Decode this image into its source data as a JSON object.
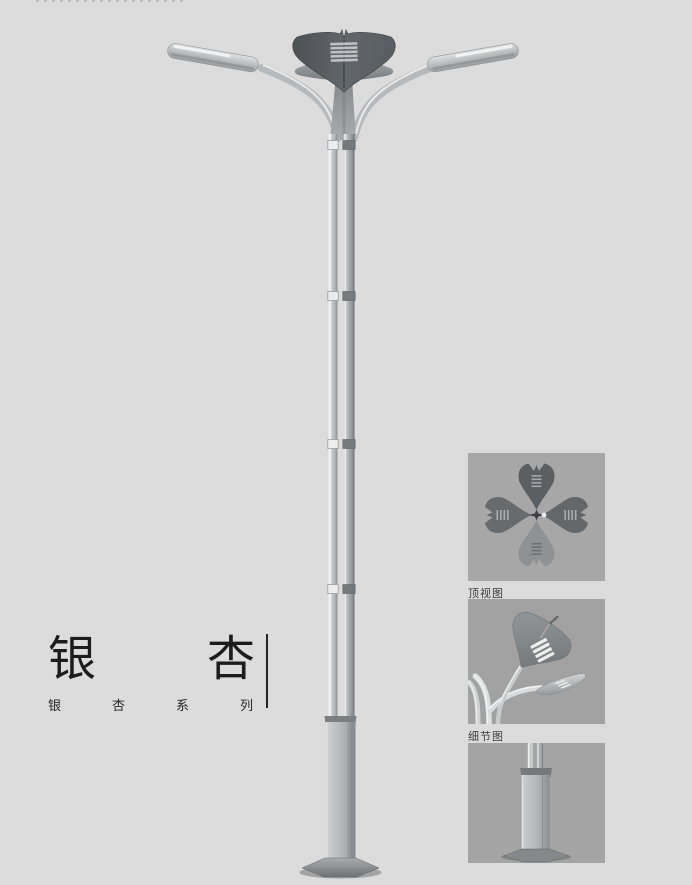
{
  "page": {
    "width": 692,
    "height": 885,
    "background": "#dcdcdd",
    "description_render": "streetlight-product-render"
  },
  "title": {
    "text": "银杏",
    "chars": [
      "银",
      "杏"
    ],
    "subtitle": "银杏系列",
    "subtitle_chars": [
      "银",
      "杏",
      "系",
      "列"
    ]
  },
  "thumbnails": [
    {
      "label": "顶视图",
      "image": "top-view-render"
    },
    {
      "label": "细节图",
      "image": "detail-render"
    },
    {
      "label": "",
      "image": "base-render"
    }
  ],
  "colors": {
    "page_bg": "#dcdcdd",
    "thumb_bg_1": "#a7a7a7",
    "thumb_bg_2": "#a2a2a2",
    "thumb_bg_3": "#a4a4a4",
    "text_dark": "#1c1c1c",
    "pole_light": "#c3c6c8",
    "pole_shadow": "#8f9396",
    "crown_dark": "#565b5e"
  }
}
